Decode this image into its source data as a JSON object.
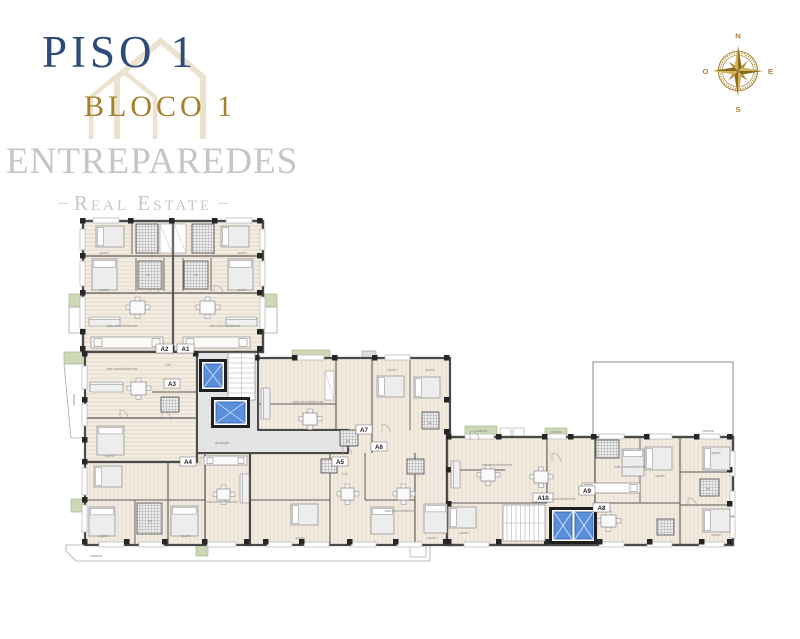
{
  "header": {
    "title": "PISO 1",
    "subtitle": "BLOCO 1"
  },
  "brand": {
    "name": "ENTREPAREDES",
    "tagline": "Real Estate"
  },
  "compass": {
    "north": "N",
    "east": "E",
    "south": "S",
    "west": "O"
  },
  "plan": {
    "units": [
      {
        "id": "A1"
      },
      {
        "id": "A2"
      },
      {
        "id": "A3"
      },
      {
        "id": "A4"
      },
      {
        "id": "A5"
      },
      {
        "id": "A6"
      },
      {
        "id": "A7"
      },
      {
        "id": "A8"
      },
      {
        "id": "A9"
      },
      {
        "id": "A10"
      }
    ],
    "rooms": {
      "living": "sala comum/kitchenet",
      "bedroom": "quarto",
      "bath": "wc",
      "hall": "hall",
      "balcony": "varanda",
      "circulation": "circulação"
    },
    "colors": {
      "title": "#2d4a78",
      "accent": "#a5802c",
      "watermark": "#c8c5c8",
      "wall": "#4a4a4a",
      "floor": "#f3ece1",
      "stripe": "#e4d5c5",
      "core": "#e4e4e4",
      "balcony_green": "#ccd8b6",
      "elevator_blue": "#5b8fd9"
    }
  }
}
